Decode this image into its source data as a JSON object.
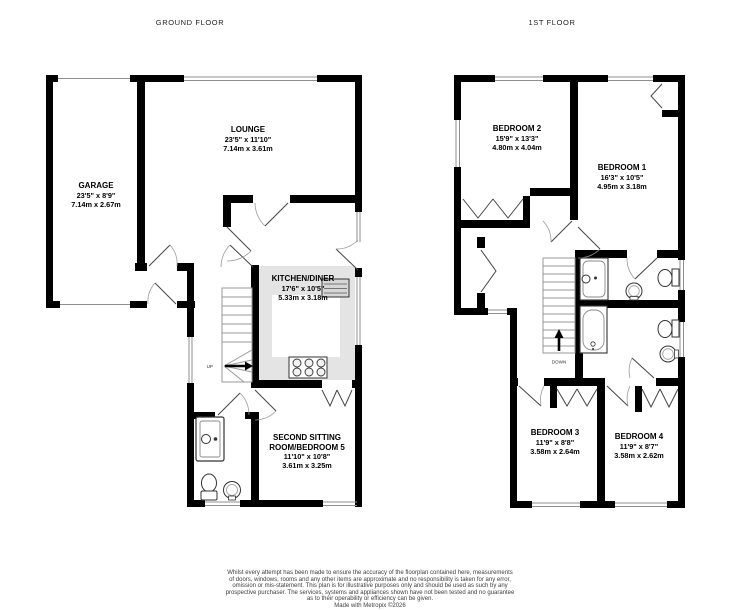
{
  "titles": {
    "ground": "GROUND FLOOR",
    "first": "1ST FLOOR"
  },
  "colors": {
    "wall": "#000000",
    "kitchen_floor": "#e4e4e4",
    "thin_line": "#8f8f8f",
    "counter": "#d6d6d6"
  },
  "ground_floor": {
    "stairs_label": "UP",
    "rooms": [
      {
        "name": "GARAGE",
        "imperial": "23'5\" x 8'9\"",
        "metric": "7.14m x 2.67m"
      },
      {
        "name": "LOUNGE",
        "imperial": "23'5\" x 11'10\"",
        "metric": "7.14m x 3.61m"
      },
      {
        "name": "KITCHEN/DINER",
        "imperial": "17'6\" x 10'5\"",
        "metric": "5.33m x 3.18m"
      },
      {
        "name": "SECOND SITTING ROOM/BEDROOM 5",
        "imperial": "11'10\" x 10'8\"",
        "metric": "3.61m x 3.25m"
      }
    ]
  },
  "first_floor": {
    "stairs_label": "DOWN",
    "rooms": [
      {
        "name": "BEDROOM 2",
        "imperial": "15'9\" x 13'3\"",
        "metric": "4.80m x 4.04m"
      },
      {
        "name": "BEDROOM 1",
        "imperial": "16'3\" x 10'5\"",
        "metric": "4.95m x 3.18m"
      },
      {
        "name": "BEDROOM 3",
        "imperial": "11'9\" x 8'8\"",
        "metric": "3.58m x 2.64m"
      },
      {
        "name": "BEDROOM 4",
        "imperial": "11'9\" x 8'7\"",
        "metric": "3.58m x 2.62m"
      }
    ]
  },
  "disclaimer": {
    "lines": [
      "Whilst every attempt has been made to ensure the accuracy of the floorplan contained here, measurements",
      "of doors, windows, rooms and any other items are approximate and no responsibility is taken for any error,",
      "omission or mis-statement. This plan is for illustrative purposes only and should be used as such by any",
      "prospective purchaser. The services, systems and appliances shown have not been tested and no guarantee",
      "as to their operability or efficiency can be given.",
      "Made with Metropix ©2026"
    ]
  }
}
